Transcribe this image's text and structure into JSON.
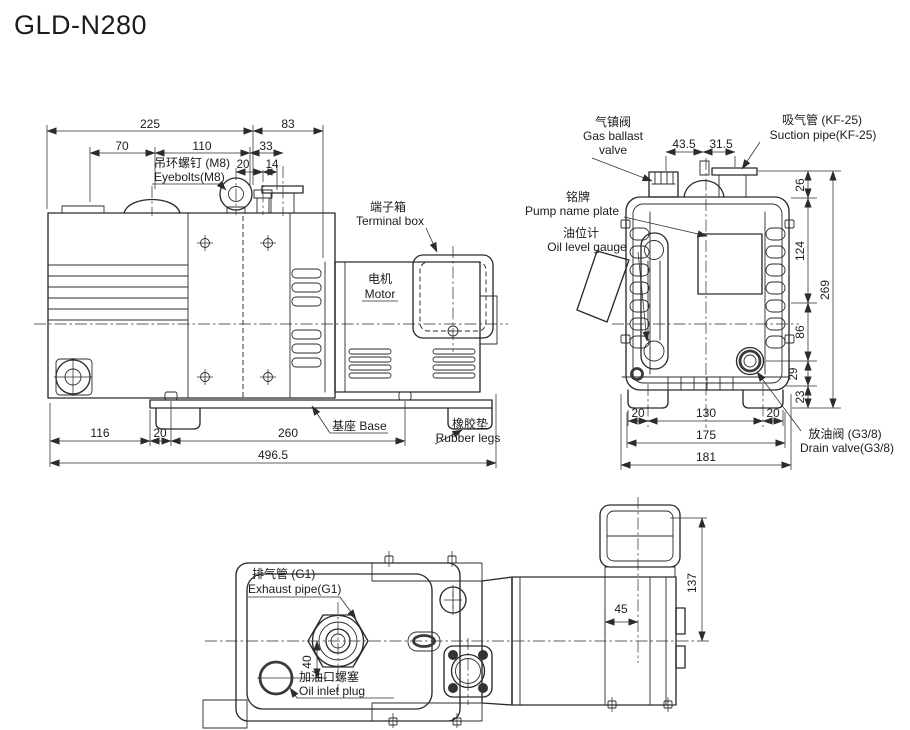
{
  "title": "GLD-N280",
  "colors": {
    "accent": "#1b79d4",
    "line": "#2b2b2b"
  },
  "side_view": {
    "dims": {
      "w225": "225",
      "w83": "83",
      "w70": "70",
      "w110": "110",
      "w33": "33",
      "w20a": "20",
      "w14": "14",
      "w116": "116",
      "w20b": "20",
      "w260": "260",
      "w496": "496.5"
    },
    "labels": {
      "eyebolts_cn": "吊环螺钉 (M8)",
      "eyebolts_en": "Eyebolts(M8)",
      "terminal_box_cn": "端子箱",
      "terminal_box_en": "Terminal box",
      "motor_cn": "电机",
      "motor_en": "Motor",
      "base": "基座 Base",
      "rubber_legs_cn": "橡胶垫",
      "rubber_legs_en": "Rubber legs"
    }
  },
  "front_view": {
    "dims": {
      "w43_5": "43.5",
      "w31_5": "31.5",
      "h26": "26",
      "h124": "124",
      "h269": "269",
      "h86": "86",
      "h29": "29",
      "h23": "23",
      "w20l": "20",
      "w130": "130",
      "w20r": "20",
      "w175": "175",
      "w181": "181"
    },
    "labels": {
      "gas_cn": "气镇阀",
      "gas_en1": "Gas ballast",
      "gas_en2": "valve",
      "suction_cn": "吸气管 (KF-25)",
      "suction_en": "Suction pipe(KF-25)",
      "plate_cn": "铭牌",
      "plate_en": "Pump name plate",
      "gauge_cn": "油位计",
      "gauge_en": "Oil level gauge",
      "drain_cn": "放油阀 (G3/8)",
      "drain_en": "Drain valve(G3/8)"
    }
  },
  "top_view": {
    "dims": {
      "h40": "40",
      "w45": "45",
      "h137": "137"
    },
    "labels": {
      "exhaust_cn": "排气管 (G1)",
      "exhaust_en": "Exhaust pipe(G1)",
      "oil_cn": "加油口螺塞",
      "oil_en": "Oil inlet plug"
    }
  }
}
